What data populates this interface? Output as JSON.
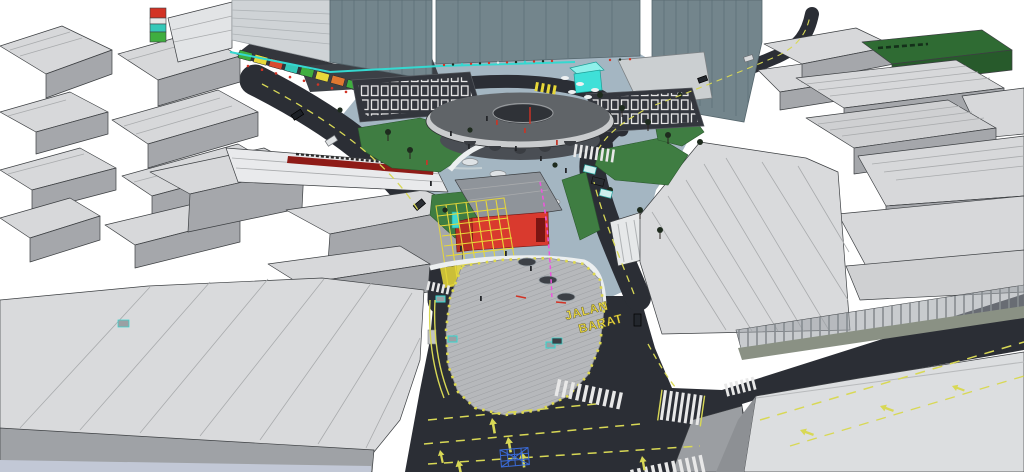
{
  "scene": {
    "type": "3d-city-model-render",
    "view": "perspective aerial of a city junction redevelopment model",
    "road_label": {
      "line1": "JALAN",
      "line2": "BARAT"
    },
    "building_sign": {
      "legible": false,
      "style": "dark lettering above dark-red band on long white building"
    },
    "landmarks": {
      "roundabout_deck": "elevated circular deck with center opening",
      "red_pavilion": "red-walled pavilion with gray hip roof",
      "scaffold": "yellow construction scaffold grid",
      "market_street": "diagonal street with colorful stall roofs",
      "parking_lot_west": "striped parking rows west of deck",
      "parking_lot_east": "striped parking rows east of deck",
      "pedestrian_plaza": "hatched teardrop plaza edged with yellow bollards",
      "main_intersection": "signalized junction with crosswalks and box marking",
      "office_towers": "tall slate-teal towers",
      "green_roof_building": "dark green roofed block, upper right",
      "city_blocks": "untextured gray massing blocks"
    },
    "colors": {
      "sky": "#ffffff",
      "asphalt": "#2b2e35",
      "road_line_yellow": "#d8d855",
      "marking_white": "#e8e8e8",
      "plaza_pavement": "#a4b6c2",
      "plaza_hatched": "#b6b8bb",
      "lawn_green": "#3f7d42",
      "tower_slate": "#73858c",
      "block_roof_gray": "#d7d8da",
      "block_face_gray": "#a5a7ab",
      "deck_top": "#63666b",
      "deck_rim": "#caccce",
      "pavilion_red": "#d93a2e",
      "scaffold_yellow": "#e8d838",
      "accent_cyan": "#35d8d0",
      "accent_magenta": "#ee55dd",
      "sign_band_red": "#8e1b17",
      "green_roof": "#2f6b33",
      "bollard_yellow": "#ded94e",
      "label_yellow": "#ecd93c",
      "box_junction_blue": "#3a6bd8"
    }
  }
}
